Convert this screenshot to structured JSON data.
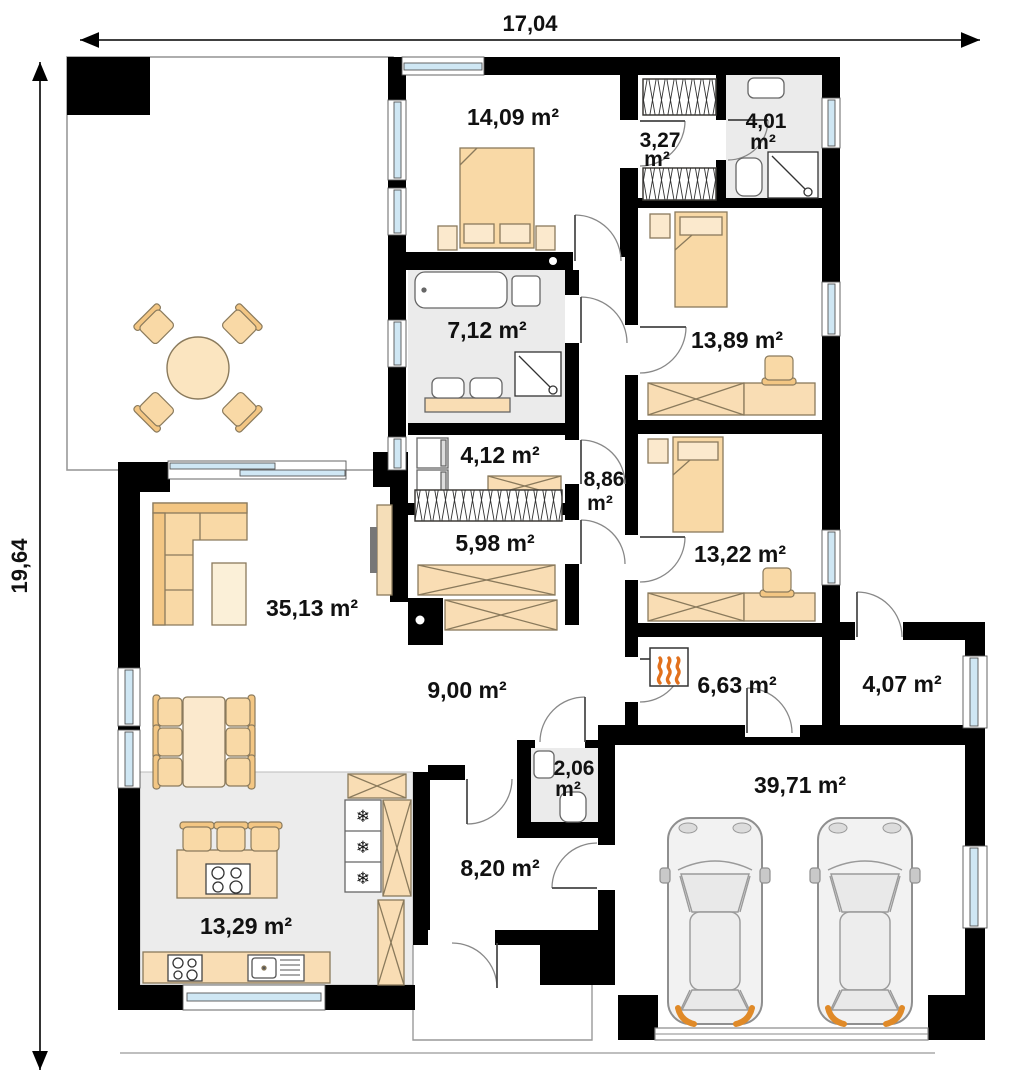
{
  "dimensions": {
    "width_label": "17,04",
    "height_label": "19,64"
  },
  "rooms": {
    "bedroom_master": {
      "label": "14,09 m²"
    },
    "closet": {
      "line1": "3,27",
      "line2": "m²"
    },
    "bathroom_ensuite": {
      "line1": "4,01",
      "line2": "m²"
    },
    "bathroom_main": {
      "label": "7,12 m²"
    },
    "laundry": {
      "label": "4,12 m²"
    },
    "bedroom_2": {
      "label": "13,89 m²"
    },
    "corridor": {
      "line1": "8,86",
      "line2": "m²"
    },
    "wardrobe_hall": {
      "label": "5,98 m²"
    },
    "bedroom_3": {
      "label": "13,22 m²"
    },
    "living_room": {
      "label": "35,13 m²"
    },
    "hall": {
      "label": "9,00 m²"
    },
    "boiler_room": {
      "label": "6,63 m²"
    },
    "pantry": {
      "label": "4,07 m²"
    },
    "wc": {
      "line1": "2,06",
      "line2": "m²"
    },
    "entry_hall": {
      "label": "8,20 m²"
    },
    "kitchen": {
      "label": "13,29 m²"
    },
    "garage": {
      "label": "39,71 m²"
    }
  },
  "icons": {
    "snowflake": "❄"
  },
  "colors": {
    "wall": "#000000",
    "furniture_beige": "#f9d9a6",
    "furniture_light": "#fbe9cd",
    "floor_gray": "#ebebeb",
    "window_glass": "#cfe7f4",
    "accent_orange": "#e08a28",
    "flame_yellow": "#f2a124"
  }
}
